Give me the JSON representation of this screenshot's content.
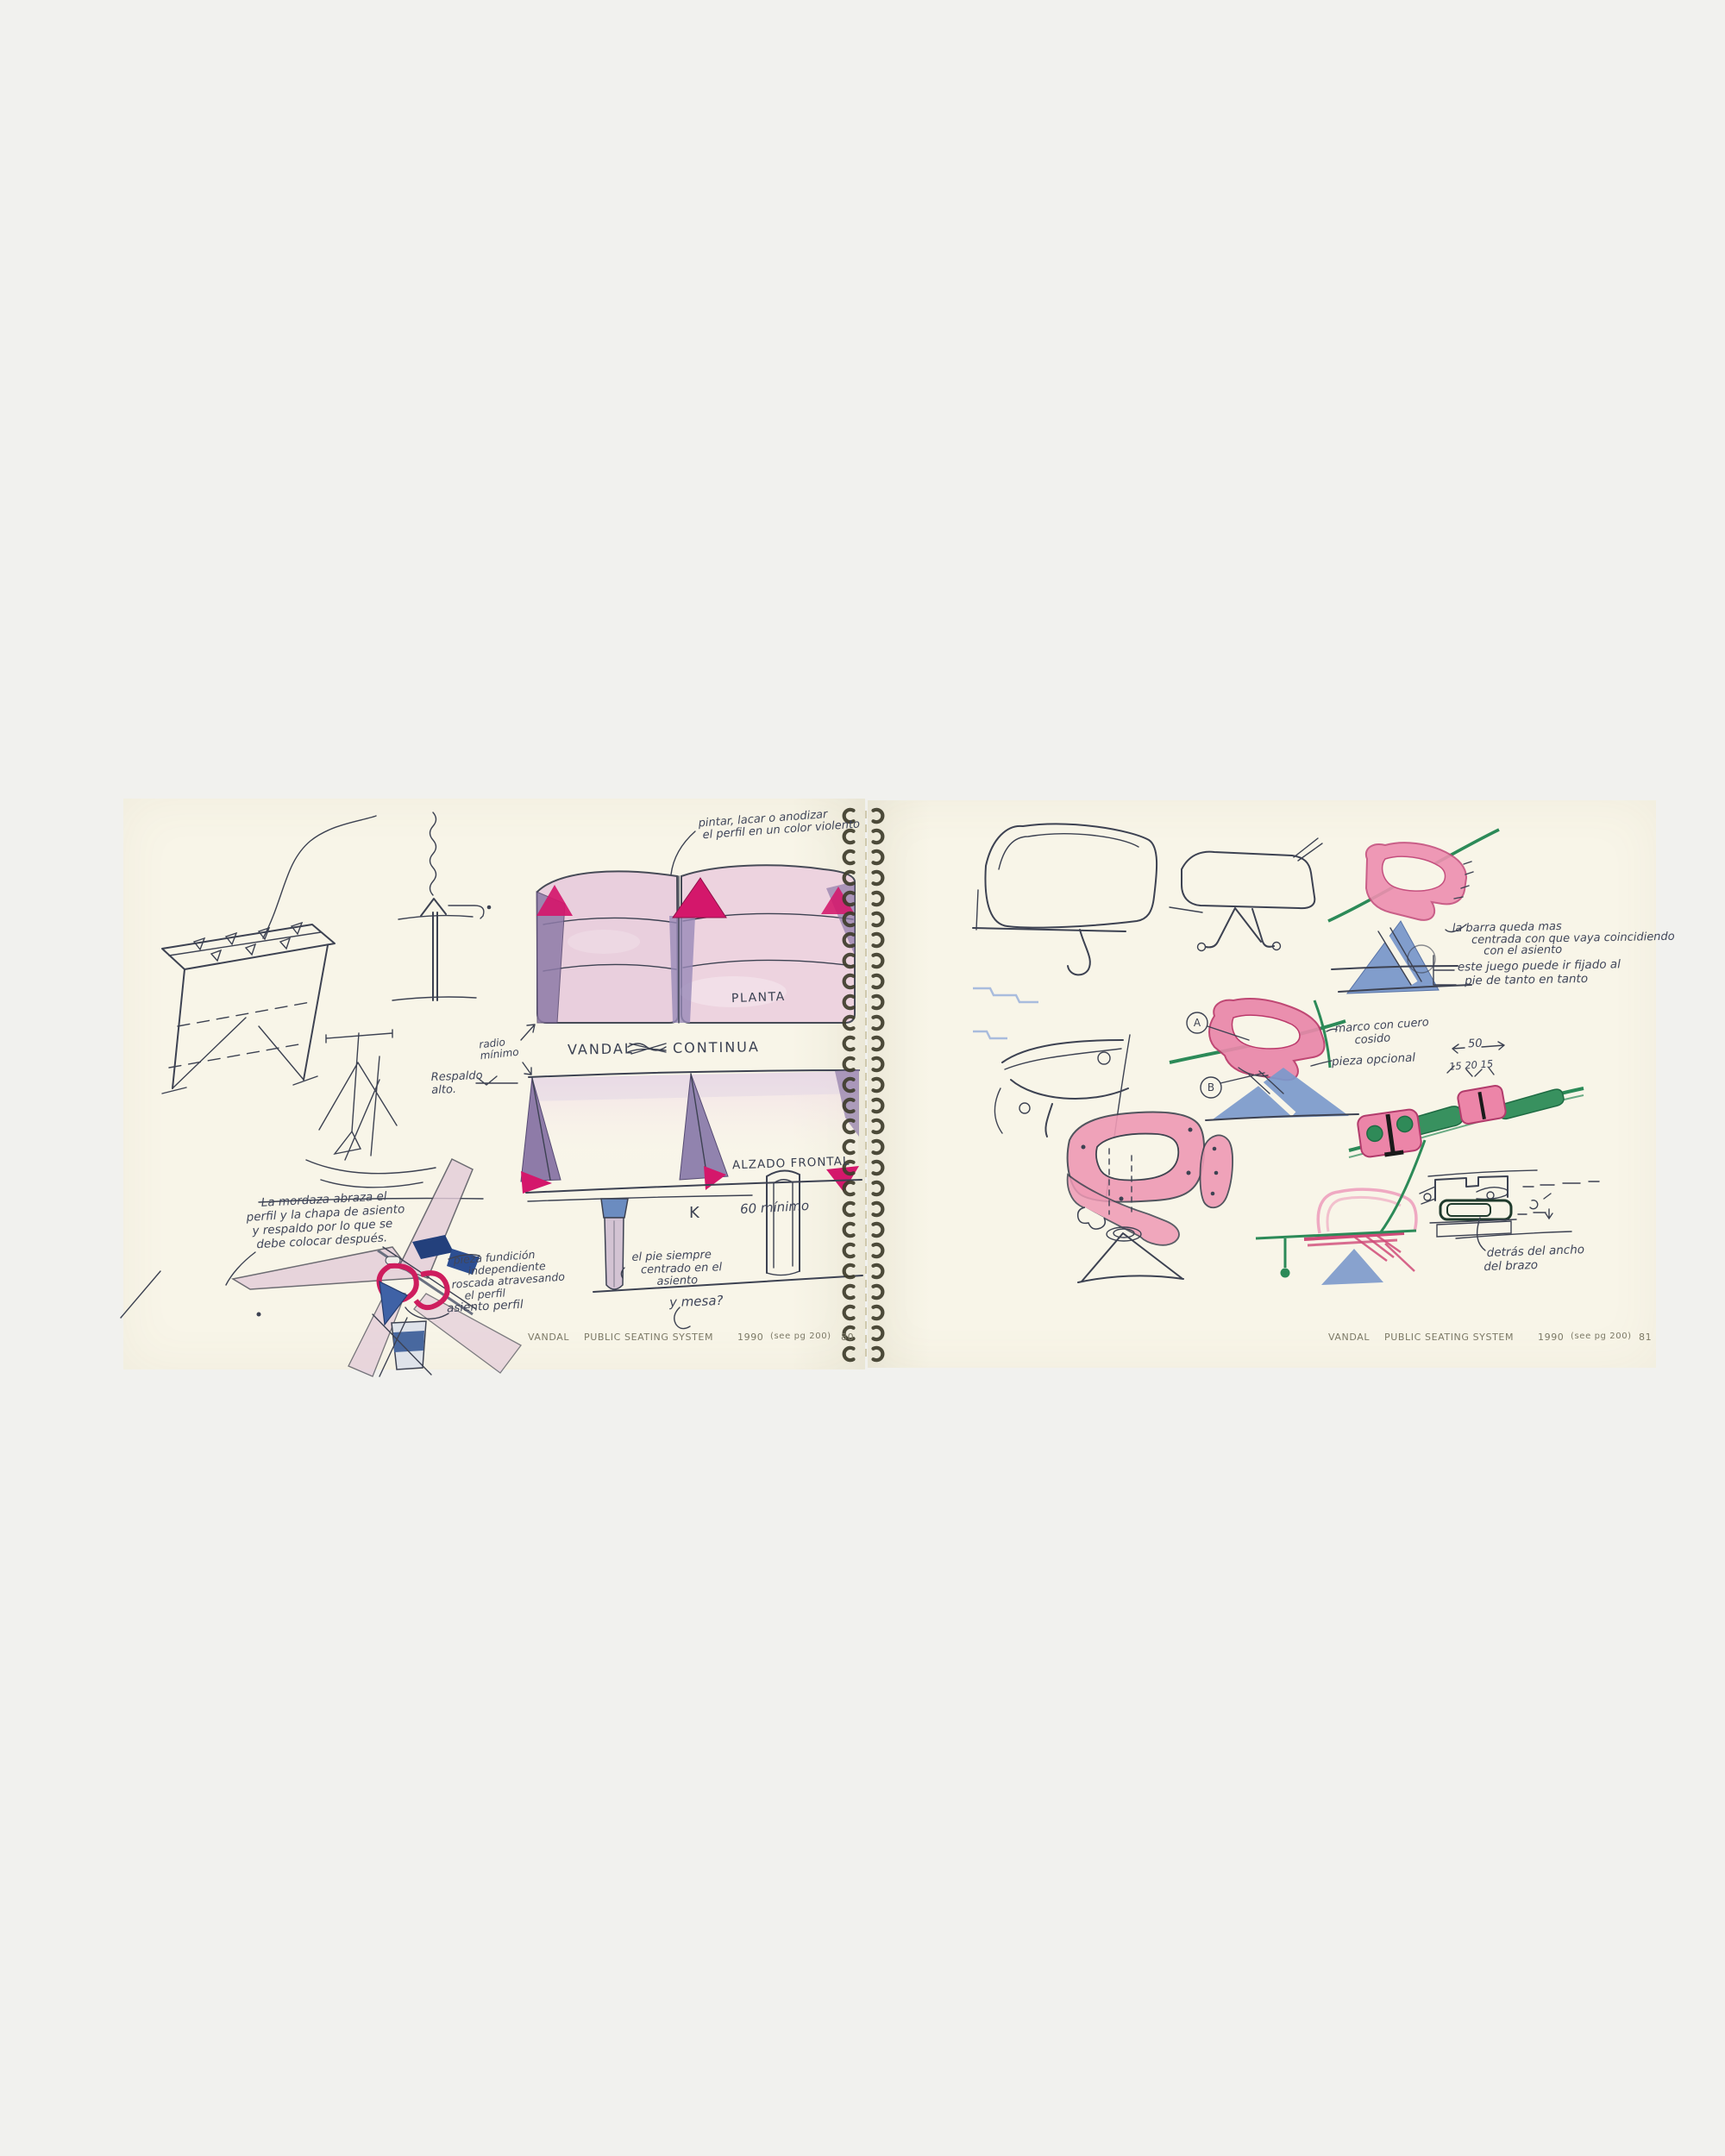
{
  "colors": {
    "paper": "#f8f5e8",
    "background": "#f1f1ee",
    "ink": "#3d4252",
    "magenta": "#d4176b",
    "purple": "#8e7ba8",
    "wash_pink": "#e9cfdd",
    "crayon_pink": "#ec8fae",
    "crayon_blue": "#7b99cb",
    "green": "#2e8b5b"
  },
  "left_page": {
    "footer": {
      "brand": "VANDAL",
      "title": "PUBLIC SEATING SYSTEM",
      "year": "1990",
      "ref": "(see pg 200)",
      "page_no": "80"
    },
    "labels": {
      "planta": "PLANTA",
      "series_word_1": "VANDAL",
      "series_word_2": "CONTINUA",
      "alzado": "ALZADO FRONTAL",
      "k": "K"
    },
    "notes": {
      "top_note": [
        "pintar, lacar o anodizar",
        "el perfil en un color violento"
      ],
      "radio": [
        "radio",
        "mínimo"
      ],
      "respaldo": [
        "Respaldo",
        "alto."
      ],
      "min60": "60 mínimo",
      "pie": [
        "el pie siempre",
        "centrado en el",
        "asiento"
      ],
      "mesa": "y mesa?",
      "mordaza": [
        "La mordaza abraza el",
        "perfil y la chapa de asiento",
        "y respaldo por lo que se",
        "debe colocar después."
      ],
      "pieza": [
        "pieza fundición",
        "independiente",
        "roscada atravesando",
        "el perfil"
      ],
      "asiento_perfil": "asiento perfil"
    }
  },
  "right_page": {
    "footer": {
      "brand": "VANDAL",
      "title": "PUBLIC SEATING SYSTEM",
      "year": "1990",
      "ref": "(see pg 200)",
      "page_no": "81"
    },
    "notes": {
      "barra": [
        "la barra queda mas",
        "centrada con que vaya coincidiendo",
        "con el asiento"
      ],
      "juego": [
        "este juego puede ir fijado al",
        "pie de tanto en tanto"
      ],
      "marco": [
        "marco con cuero",
        "cosido"
      ],
      "pieza_opcional": "pieza opcional",
      "dim_main": "50",
      "dim_sub": "15   20   15",
      "detras": [
        "detrás del ancho",
        "del brazo"
      ]
    },
    "callouts": {
      "a": "A",
      "b": "B"
    }
  }
}
